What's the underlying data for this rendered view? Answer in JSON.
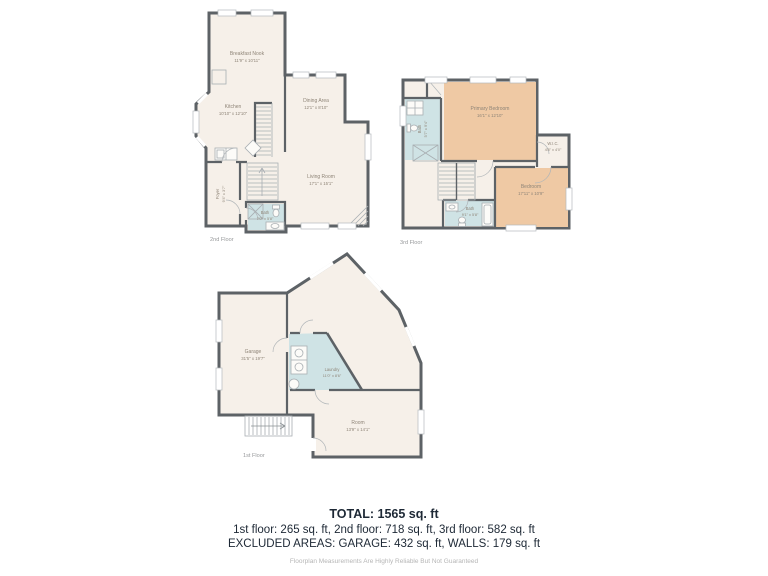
{
  "floors": {
    "second": {
      "label": "2nd Floor",
      "rooms": {
        "breakfast_nook": {
          "name": "Breakfast Nook",
          "dims": "11'9\" x 10'11\""
        },
        "kitchen": {
          "name": "Kitchen",
          "dims": "10'10\" x 12'10\""
        },
        "dining": {
          "name": "Dining Area",
          "dims": "12'1\" x 8'10\""
        },
        "living": {
          "name": "Living Room",
          "dims": "17'1\" x 15'1\""
        },
        "bath": {
          "name": "Bath",
          "dims": "7'0\" x 5'8\""
        },
        "foyer": {
          "name": "Foyer",
          "dims": "9'4\" x 3'7\""
        }
      }
    },
    "third": {
      "label": "3rd Floor",
      "rooms": {
        "primary_bedroom": {
          "name": "Primary Bedroom",
          "dims": "16'1\" x 12'10\""
        },
        "wic": {
          "name": "W.I.C.",
          "dims": "4'8\" x 4'0\""
        },
        "bath_upper": {
          "name": "Bath",
          "dims": "5'7\" x 9'4\""
        },
        "bath_lower": {
          "name": "Bath",
          "dims": "9'1\" x 5'8\""
        },
        "bedroom": {
          "name": "Bedroom",
          "dims": "17'11\" x 10'9\""
        }
      }
    },
    "first": {
      "label": "1st Floor",
      "rooms": {
        "garage": {
          "name": "Garage",
          "dims": "31'5\" x 19'7\""
        },
        "laundry": {
          "name": "Laundry",
          "dims": "11'0\" x 8'6\""
        },
        "room": {
          "name": "Room",
          "dims": "13'9\" x 14'1\""
        }
      }
    }
  },
  "summary": {
    "total": "TOTAL: 1565 sq. ft",
    "floors_line": "1st floor: 265 sq. ft, 2nd floor: 718 sq. ft, 3rd floor: 582 sq. ft",
    "excluded_line": "EXCLUDED AREAS: GARAGE: 432 sq. ft, WALLS: 179 sq. ft",
    "disclaimer": "Floorplan Measurements Are Highly Reliable But Not Guaranteed"
  },
  "colors": {
    "wall": "#5d6266",
    "floor_fill": "#f6f0e9",
    "bedroom_fill": "#efc9a4",
    "wet_room_fill": "#cfe3e5",
    "label_text": "#8f8578",
    "summary_text": "#1d2835"
  }
}
